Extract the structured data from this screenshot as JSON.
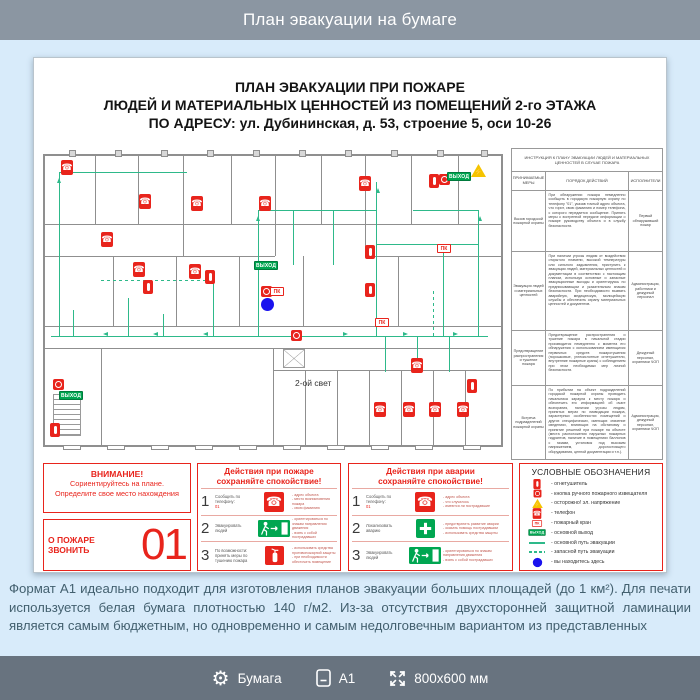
{
  "header": {
    "title": "План эвакуации на бумаге"
  },
  "poster": {
    "title_lines": [
      "ПЛАН ЭВАКУАЦИИ ПРИ ПОЖАРЕ",
      "ЛЮДЕЙ И МАТЕРИАЛЬНЫХ ЦЕННОСТЕЙ ИЗ ПОМЕЩЕНИЙ 2-го ЭТАЖА",
      "ПО АДРЕСУ: ул. Дубининская, д. 53, строение 5, оси 10-26"
    ],
    "floor_plan": {
      "area_label": "2-ой свет",
      "area_label_pos": [
        252,
        230
      ],
      "sign_labels": {
        "pk": "ПК",
        "exit": "ВЫХОД",
        "voltage": "⚡"
      },
      "walls": [
        [
          0,
          6,
          460,
          2
        ],
        [
          0,
          297,
          460,
          2
        ],
        [
          0,
          6,
          2,
          293
        ],
        [
          458,
          6,
          2,
          293
        ],
        [
          52,
          8,
          1,
          68
        ],
        [
          95,
          8,
          1,
          68
        ],
        [
          140,
          8,
          1,
          100
        ],
        [
          188,
          8,
          1,
          68
        ],
        [
          232,
          8,
          1,
          100
        ],
        [
          278,
          8,
          1,
          68
        ],
        [
          322,
          8,
          1,
          100
        ],
        [
          368,
          8,
          1,
          68
        ],
        [
          415,
          8,
          1,
          68
        ],
        [
          0,
          76,
          460,
          1
        ],
        [
          0,
          108,
          232,
          1
        ],
        [
          322,
          108,
          136,
          1
        ],
        [
          70,
          108,
          1,
          70
        ],
        [
          133,
          108,
          1,
          70
        ],
        [
          196,
          108,
          1,
          70
        ],
        [
          260,
          108,
          1,
          70
        ],
        [
          355,
          108,
          1,
          70
        ],
        [
          400,
          108,
          1,
          70
        ],
        [
          0,
          178,
          460,
          1
        ],
        [
          0,
          200,
          460,
          1
        ],
        [
          58,
          200,
          1,
          97
        ],
        [
          230,
          200,
          1,
          97
        ],
        [
          230,
          222,
          228,
          1
        ],
        [
          262,
          222,
          1,
          75
        ],
        [
          294,
          222,
          1,
          75
        ],
        [
          326,
          222,
          1,
          75
        ],
        [
          358,
          222,
          1,
          75
        ],
        [
          390,
          222,
          1,
          75
        ],
        [
          422,
          222,
          1,
          75
        ]
      ],
      "columns": [
        [
          26,
          2,
          7,
          7
        ],
        [
          72,
          2,
          7,
          7
        ],
        [
          118,
          2,
          7,
          7
        ],
        [
          164,
          2,
          7,
          7
        ],
        [
          210,
          2,
          7,
          7
        ],
        [
          256,
          2,
          7,
          7
        ],
        [
          302,
          2,
          7,
          7
        ],
        [
          348,
          2,
          7,
          7
        ],
        [
          394,
          2,
          7,
          7
        ],
        [
          438,
          2,
          7,
          7
        ]
      ],
      "windows": [
        [
          20,
          297,
          18,
          5
        ],
        [
          64,
          297,
          18,
          5
        ],
        [
          108,
          297,
          18,
          5
        ],
        [
          152,
          297,
          18,
          5
        ],
        [
          196,
          297,
          18,
          5
        ],
        [
          240,
          297,
          18,
          5
        ],
        [
          284,
          297,
          18,
          5
        ],
        [
          328,
          297,
          18,
          5
        ],
        [
          372,
          297,
          18,
          5
        ],
        [
          420,
          297,
          18,
          5
        ]
      ],
      "paths": [
        [
          8,
          188,
          437,
          1,
          0
        ],
        [
          30,
          162,
          1,
          26,
          0
        ],
        [
          85,
          150,
          1,
          38,
          0
        ],
        [
          120,
          166,
          1,
          22,
          0
        ],
        [
          170,
          122,
          1,
          66,
          0
        ],
        [
          215,
          62,
          1,
          126,
          0
        ],
        [
          215,
          62,
          118,
          1,
          0
        ],
        [
          250,
          62,
          1,
          55,
          0
        ],
        [
          290,
          62,
          1,
          55,
          0
        ],
        [
          333,
          34,
          1,
          154,
          0
        ],
        [
          333,
          96,
          102,
          1,
          0
        ],
        [
          400,
          96,
          1,
          92,
          0
        ],
        [
          435,
          62,
          1,
          126,
          0
        ],
        [
          370,
          62,
          65,
          1,
          0
        ],
        [
          342,
          188,
          1,
          36,
          0
        ],
        [
          374,
          188,
          1,
          36,
          0
        ],
        [
          406,
          188,
          1,
          36,
          0
        ],
        [
          16,
          24,
          1,
          164,
          0
        ],
        [
          16,
          24,
          128,
          1,
          0
        ],
        [
          58,
          132,
          110,
          1,
          1
        ],
        [
          390,
          140,
          1,
          48,
          1
        ]
      ],
      "arrows": [
        [
          60,
          186,
          "left"
        ],
        [
          110,
          186,
          "left"
        ],
        [
          160,
          186,
          "left"
        ],
        [
          250,
          186,
          "left"
        ],
        [
          300,
          186,
          "right"
        ],
        [
          360,
          186,
          "right"
        ],
        [
          410,
          186,
          "right"
        ],
        [
          213,
          70,
          "up"
        ],
        [
          333,
          42,
          "up"
        ],
        [
          435,
          70,
          "up"
        ],
        [
          14,
          32,
          "up"
        ]
      ],
      "stairs": [
        [
          10,
          246,
          28,
          42,
          "s"
        ],
        [
          240,
          201,
          22,
          19,
          "x"
        ]
      ],
      "markers": [
        [
          "phone",
          18,
          12
        ],
        [
          "phone",
          96,
          46
        ],
        [
          "phone",
          148,
          48
        ],
        [
          "phone",
          216,
          48
        ],
        [
          "phone",
          316,
          28
        ],
        [
          "phone",
          58,
          84
        ],
        [
          "phone",
          90,
          114
        ],
        [
          "phone",
          146,
          116
        ],
        [
          "phone",
          368,
          210
        ],
        [
          "phone",
          331,
          254
        ],
        [
          "phone",
          360,
          254
        ],
        [
          "phone",
          386,
          254
        ],
        [
          "phone",
          414,
          254
        ],
        [
          "ext",
          100,
          132
        ],
        [
          "ext",
          162,
          122
        ],
        [
          "ext",
          386,
          26
        ],
        [
          "ext",
          322,
          97
        ],
        [
          "ext",
          322,
          135
        ],
        [
          "ext",
          424,
          231
        ],
        [
          "ext",
          7,
          275
        ],
        [
          "btn",
          396,
          26
        ],
        [
          "btn",
          218,
          138
        ],
        [
          "btn",
          248,
          182
        ],
        [
          "btn",
          10,
          231
        ],
        [
          "pk",
          394,
          96
        ],
        [
          "pk",
          227,
          139
        ],
        [
          "pk",
          332,
          170
        ],
        [
          "exitsign",
          404,
          24
        ],
        [
          "exitsign",
          211,
          113
        ],
        [
          "exitsign",
          16,
          243
        ],
        [
          "tri",
          428,
          16
        ],
        [
          "dot",
          218,
          150
        ]
      ]
    },
    "instruction_table": {
      "title": "ИНСТРУКЦИЯ К ПЛАНУ ЭВАКУАЦИИ ЛЮДЕЙ И МАТЕРИАЛЬНЫХ ЦЕННОСТЕЙ В СЛУЧАЕ ПОЖАРА",
      "columns": [
        "ПРИНИМАЕМЫЕ МЕРЫ",
        "ПОРЯДОК ДЕЙСТВИЙ",
        "ИСПОЛНИТЕЛИ"
      ],
      "rows": [
        {
          "measure": "Вызов городской пожарной охраны",
          "actions": "При обнаружении пожара немедленно сообщить в городскую пожарную охрану по телефону \"01\", указав точный адрес объекта, что горит, свою фамилию и номер телефона, с которого передается сообщение. Принять меры к экстренной передаче информации о пожаре руководству объекта и в службу безопасности.",
          "executors": "Первый обнаруживший пожар"
        },
        {
          "measure": "Эвакуация людей и материальных ценностей",
          "actions": "При наличии угрозы людям от воздействия открытого пламени, высокой температуры или сильного задымления, приступить к эвакуации людей, материальных ценностей и документации в соответствии с настоящим планом, используя основные и запасные эвакуационные выходы и ориентируясь по предписывающим и указательным знакам безопасности. При необходимости вызвать аварийную, медицинскую, милицейскую службы и обеспечить охрану материальных ценностей и документов.",
          "executors": "Администрация, работники и дежурный персонал"
        },
        {
          "measure": "Предотвращение распространения и тушение пожара",
          "actions": "Предотвращение распространения и тушение пожара в начальной стадии производится немедленно с момента его обнаружения с использованием имеющихся первичных средств пожаротушения (порошковые, углекислотные огнетушители, внутренние пожарные краны) с соблюдением при этом необходимых мер личной безопасности.",
          "executors": "Дежурный персонал, охранники ЧОП"
        },
        {
          "measure": "Встреча подразделений пожарной охраны",
          "actions": "По прибытии на объект подразделений городской пожарной охраны проводить начальника караула к месту пожара и обеспечить его информацией об очаге возгорания, наличии угрозы людям, принятых мерах по ликвидации пожара, характерных особенностях помещений и других специфических, имеющих значение сведениях, влияющих на обстановку и принятие решений при пожаре на объекте (места расположения наружных пожарных гидрантов, наличие в помещениях баллонов с газами, установок под высоким напряжением, дорогостоящего оборудования, ценной документации и т.п.).",
          "executors": "Администрация, дежурный персонал, охранники ЧОП"
        }
      ]
    },
    "attention": {
      "title": "ВНИМАНИЕ!",
      "line2": "Сориентируйтесь на плане.",
      "line3": "Определите свое место нахождения",
      "call_label": "О ПОЖАРЕ ЗВОНИТЬ",
      "call_number": "01"
    },
    "fire_actions": {
      "title": "Действия при пожаре",
      "subtitle": "сохраняйте спокойствие!",
      "rows": [
        {
          "num": "1",
          "label": "Сообщить по телефону:",
          "sub": "01",
          "icon": "phone-icon",
          "notes": [
            "- адрес объекта",
            "- место возникновения пожара",
            "- свою фамилию"
          ]
        },
        {
          "num": "2",
          "label": "Эвакуировать людей",
          "icon": "exit-icon",
          "notes": [
            "- ориентироваться по знакам направления движения",
            "- взять с собой пострадавших"
          ]
        },
        {
          "num": "3",
          "label": "По возможности: принять меры по тушению пожара",
          "icon": "extinguisher-icon",
          "notes": [
            "- использовать средства противопожарной защиты",
            "- при необходимости обесточить помещение"
          ]
        }
      ]
    },
    "accident_actions": {
      "title": "Действия при аварии",
      "subtitle": "сохраняйте спокойствие!",
      "rows": [
        {
          "num": "1",
          "label": "Сообщить по телефону:",
          "sub": "01",
          "icon": "phone-icon",
          "notes": [
            "- адрес объекта",
            "- что случилось",
            "- имеются ли пострадавшие"
          ]
        },
        {
          "num": "2",
          "label": "Локализовать аварию",
          "icon": "cross-icon",
          "notes": [
            "- предотвратить развитие аварии",
            "- оказать помощь пострадавшим",
            "- использовать средства защиты"
          ]
        },
        {
          "num": "3",
          "label": "Эвакуировать людей",
          "icon": "exit-icon",
          "notes": [
            "- ориентироваться по знакам направления движения",
            "- взять с собой пострадавших"
          ]
        }
      ]
    },
    "legend": {
      "title": "УСЛОВНЫЕ ОБОЗНАЧЕНИЯ",
      "items": [
        {
          "icon": "extinguisher-icon",
          "label": "- огнетушитель"
        },
        {
          "icon": "alarm-button-icon",
          "label": "- кнопка ручного пожарного извещателя"
        },
        {
          "icon": "voltage-warning-icon",
          "label": "- осторожно! эл. напряжение"
        },
        {
          "icon": "phone-icon",
          "label": "- телефон"
        },
        {
          "icon": "fire-hydrant-icon",
          "label": "- пожарный кран"
        },
        {
          "icon": "exit-sign-icon",
          "label": "- основной выход"
        },
        {
          "icon": "main-route-icon",
          "label": "- основной путь эвакуации"
        },
        {
          "icon": "reserve-route-icon",
          "label": "- запасной путь эвакуации"
        },
        {
          "icon": "you-are-here-icon",
          "label": "- вы находитесь здесь"
        }
      ]
    }
  },
  "description": {
    "text": "Формат А1 идеально подходит для изготовления планов эвакуации больших площадей (до 1 км²). Для печати используется белая бумага плотностью 140 г/м2. Из-за отсутствия двухсторонней защитной ламинации является самым бюджетным, но одновременно и самым недолговечным вариантом из представленных"
  },
  "footer": {
    "items": [
      {
        "icon": "gear-icon",
        "label": "Бумага"
      },
      {
        "icon": "document-icon",
        "label": "А1"
      },
      {
        "icon": "resize-icon",
        "label": "800x600 мм"
      }
    ]
  }
}
